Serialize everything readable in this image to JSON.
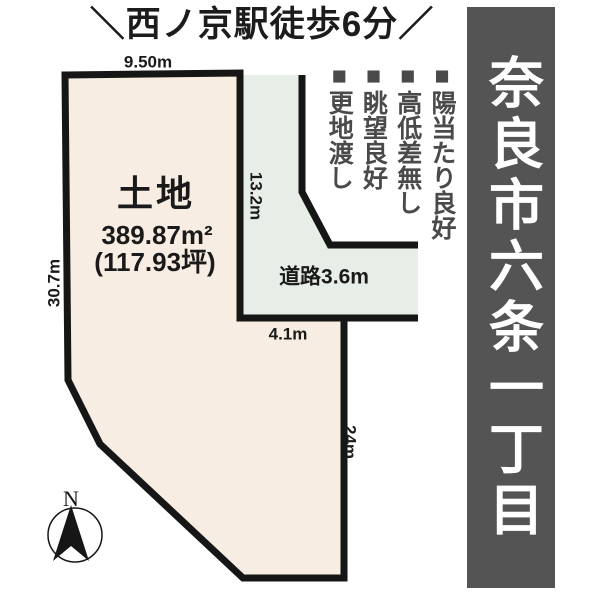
{
  "header": {
    "station_note": "＼西ノ京駅徒歩6分／"
  },
  "banner": {
    "location": "奈良市六条一丁目",
    "bg_color": "#545454",
    "text_color": "#ffffff"
  },
  "features": [
    "■陽当たり良好",
    "■高低差無し",
    "■眺望良好",
    "■更地渡し"
  ],
  "plot": {
    "label": "土地",
    "area_sqm": "389.87m²",
    "area_tsubo": "(117.93坪)",
    "fill_color": "#f7ede2",
    "outline_color": "#161616",
    "dimensions": {
      "top": "9.50m",
      "left": "30.7m",
      "inner_vertical": "13.2m",
      "bottom_inner": "4.1m",
      "right": "24m"
    }
  },
  "road": {
    "label": "道路3.6m",
    "fill_color": "#e7eee7"
  },
  "compass": {
    "north_label": "N"
  }
}
